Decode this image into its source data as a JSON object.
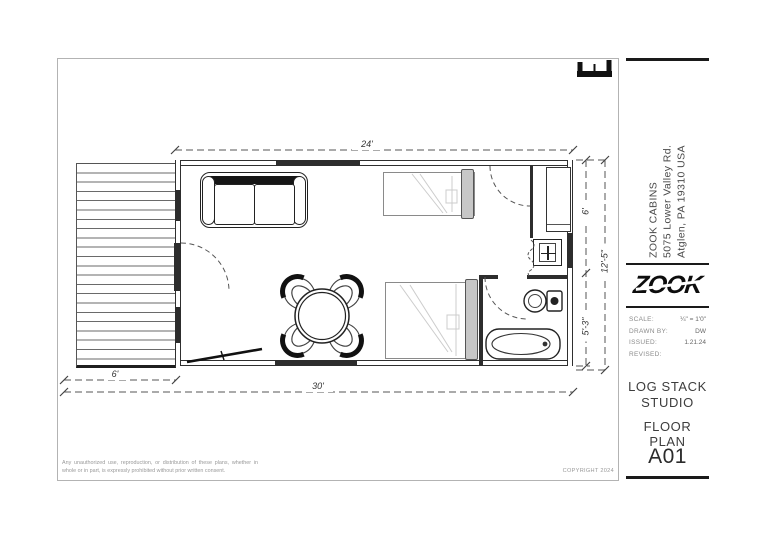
{
  "plan": {
    "dim_top": "24'",
    "dim_bottom": "30'",
    "dim_deck": "6'",
    "dim_right_upper": "6'",
    "dim_right_lower": "5'-3\"",
    "dim_right_overall": "12'-5\"",
    "copyright": "COPYRIGHT 2024",
    "disclaimer": "Any unauthorized use, reproduction, or distribution of these plans, whether in whole or in part, is expressly prohibited without prior written consent."
  },
  "title_block": {
    "company": {
      "name": "ZOOK CABINS",
      "address1": "5075 Lower Valley Rd.",
      "address2": "Atglen, PA 19310 USA"
    },
    "logo_text": "ZOOK",
    "fields": [
      {
        "label": "SCALE:",
        "value": "¼\" = 1'0\""
      },
      {
        "label": "DRAWN BY:",
        "value": "DW"
      },
      {
        "label": "ISSUED:",
        "value": "1.21.24"
      },
      {
        "label": "REVISED:",
        "value": ""
      }
    ],
    "project_line1": "LOG STACK",
    "project_line2": "STUDIO",
    "drawing_title": "FLOOR PLAN",
    "sheet_number": "A01"
  },
  "colors": {
    "ink": "#1a1a1a",
    "wall_fill": "#2d2d2d",
    "dim_line": "#555555"
  }
}
